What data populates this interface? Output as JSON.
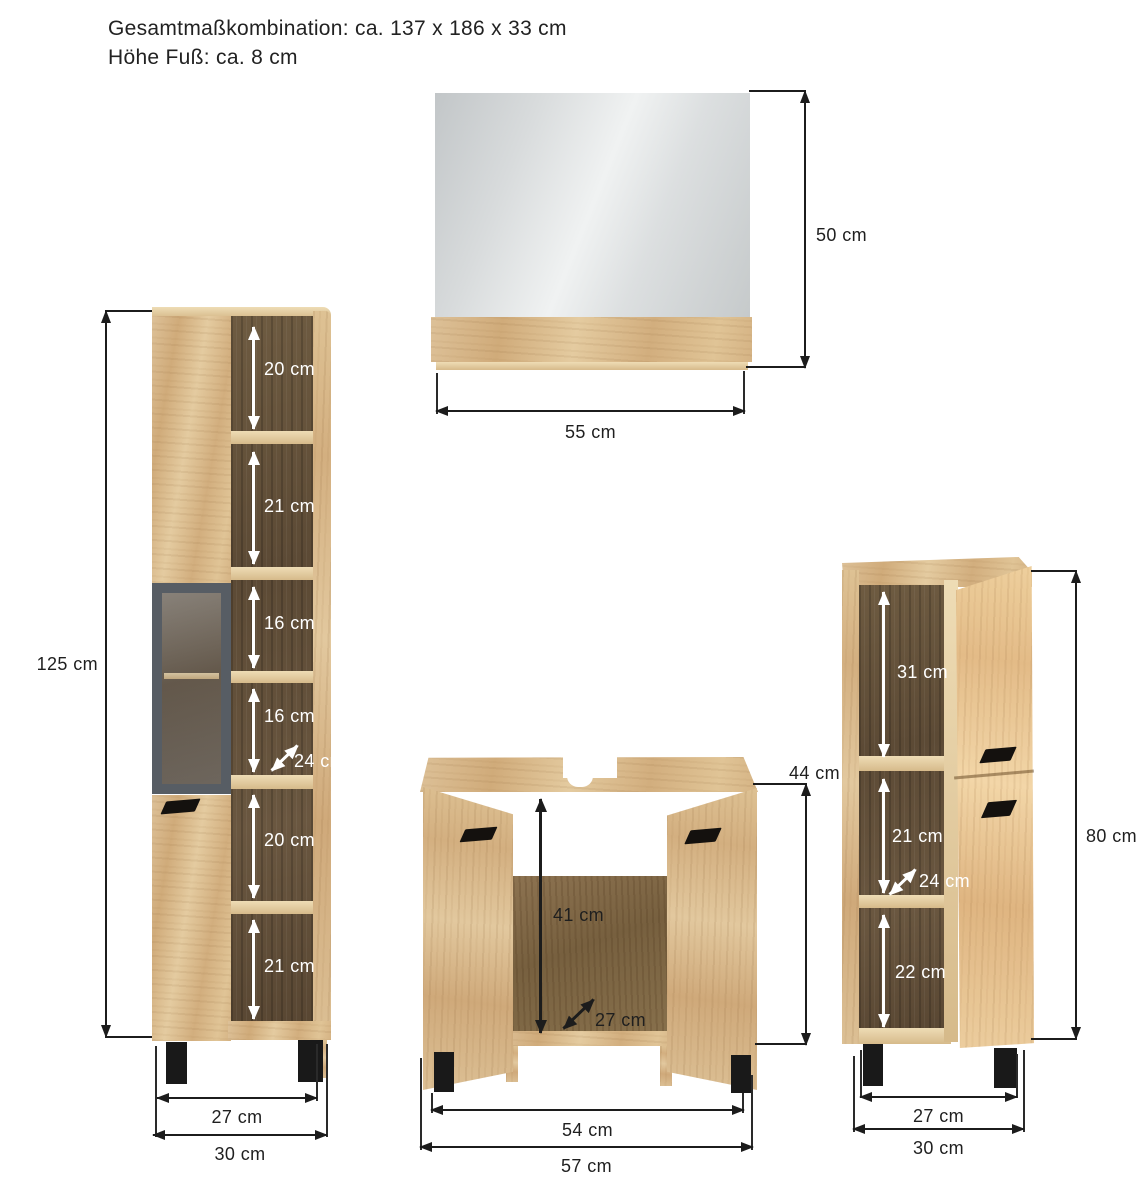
{
  "header": {
    "title_line1": "Gesamtmaßkombination: ca. 137 x 186 x 33 cm",
    "title_line2": "Höhe Fuß: ca. 8 cm"
  },
  "tall_cabinet": {
    "height": "125 cm",
    "compartments": [
      "20 cm",
      "21 cm",
      "16 cm",
      "16 cm",
      "20 cm",
      "21 cm"
    ],
    "depth": "24 cm",
    "inner_width": "27 cm",
    "outer_width": "30 cm"
  },
  "mirror": {
    "height": "50 cm",
    "width": "55 cm"
  },
  "sink_cabinet": {
    "height": "44 cm",
    "inner_height": "41 cm",
    "depth": "27 cm",
    "inner_width": "54 cm",
    "outer_width": "57 cm"
  },
  "side_cabinet": {
    "height": "80 cm",
    "compartments": [
      "31 cm",
      "21 cm",
      "22 cm"
    ],
    "depth": "24 cm",
    "inner_width": "27 cm",
    "outer_width": "30 cm"
  },
  "colors": {
    "wood_light": "#dcc094",
    "wood_shadow": "#cfa878",
    "wood_interior_dark": "#5c4a35",
    "glass_frame_gray": "#575d64",
    "mirror_gray": "#dfe2e3",
    "line_black": "#1c1c1c",
    "arrow_white": "#ffffff"
  }
}
